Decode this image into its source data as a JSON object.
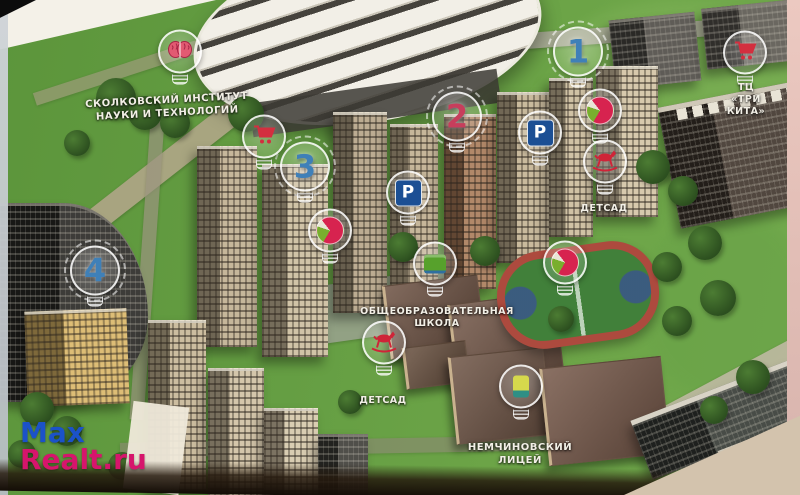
{
  "map": {
    "title": "Residential complex masterplan (aerial render)",
    "markers": {
      "skolkovo": {
        "label": "СКОЛКОВСКИЙ ИНСТИТУТ\nНАУКИ И ТЕХНОЛОГИЙ"
      },
      "building1": {
        "number": "1"
      },
      "building2": {
        "number": "2"
      },
      "building3": {
        "number": "3"
      },
      "building4": {
        "number": "4"
      },
      "parking": {
        "letter": "P"
      },
      "kindergarten_north": {
        "label": "ДЕТСАД"
      },
      "kindergarten_south": {
        "label": "ДЕТСАД"
      },
      "school": {
        "label": "ОБЩЕОБРАЗОВАТЕЛЬНАЯ\nШКОЛА"
      },
      "lyceum": {
        "label": "НЕМЧИНОВСКИЙ\nЛИЦЕЙ"
      },
      "mall": {
        "label": "ТЦ\n«ТРИ КИТА»"
      }
    },
    "icons": {
      "brain": "brain-icon",
      "shopping_cart": "shopping-cart-icon",
      "beach_ball": "beach-ball-icon",
      "rocking_horse": "rocking-horse-icon",
      "school_book": "school-book-icon",
      "lyceum_book": "lyceum-book-icon",
      "parking": "parking-icon"
    },
    "colors": {
      "number_blue": "#3f80b8",
      "number_red": "#c73e5c",
      "marker_outline": "#ffffff",
      "parking_blue": "#1c4f94",
      "ball_red": "#d7234f",
      "ball_green": "#79ae2e",
      "horse_red": "#cf2438",
      "brain_pink": "#e25a72",
      "school_green": "#57a12c",
      "lyceum_yellow": "#d6d84c",
      "lawn_green": "#619a40"
    }
  },
  "watermark": {
    "line1": "Max",
    "line2": "Realt.ru",
    "color1": "#1b52c9",
    "color2": "#d6156c"
  }
}
